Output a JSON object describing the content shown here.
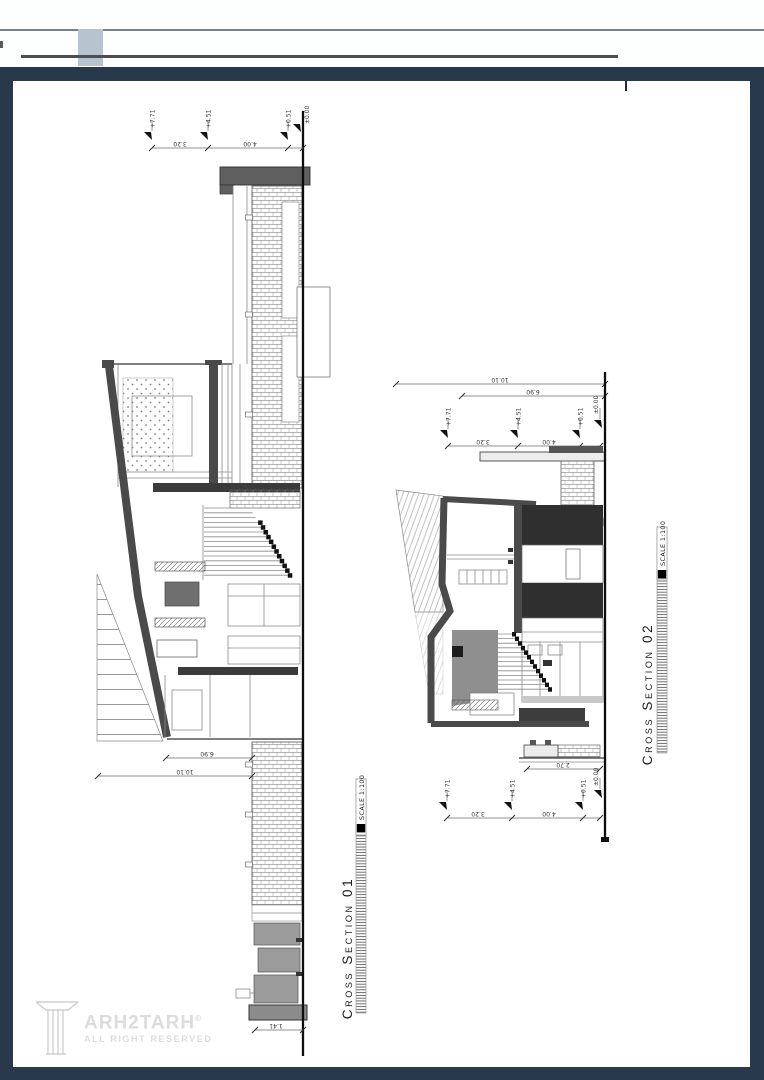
{
  "colors": {
    "frame_navy": "#27394b",
    "header_accent_bluegray": "#b7c4d0",
    "header_rule_gray": "#77838d",
    "header_bar_dark": "#4e4e4e",
    "drawing_wall_dark": "#4a4a4a",
    "slab_dark": "#2f2f2f",
    "watermark_gray": "#dcdcdc"
  },
  "sections": [
    {
      "name": "cross-section-01",
      "title": "Cross Section 01",
      "scale_label": "SCALE 1:100",
      "annotations": {
        "levels_top": [
          "+7.71",
          "+4.51",
          "+0.51",
          "±0.00"
        ],
        "dims_top": [
          "3.20",
          "4.00"
        ],
        "dims_left": [
          "6.90",
          "10.10"
        ],
        "dim_footing": "1.41"
      }
    },
    {
      "name": "cross-section-02",
      "title": "Cross Section 02",
      "scale_label": "SCALE 1:100",
      "annotations": {
        "dims_span": [
          "10.10",
          "6.90"
        ],
        "levels_top": [
          "+7.71",
          "+4.51",
          "+0.51",
          "±0.00"
        ],
        "dims_top": [
          "3.20",
          "4.00"
        ],
        "dim_roof": "2.70",
        "levels_bottom": [
          "+7.71",
          "+4.51",
          "+0.51",
          "±0.00"
        ],
        "dims_bottom": [
          "3.20",
          "4.00"
        ]
      }
    }
  ],
  "watermark": {
    "brand": "ARH2TARH",
    "copyright_symbol": "©",
    "tagline": "ALL RIGHT RESERVED"
  }
}
